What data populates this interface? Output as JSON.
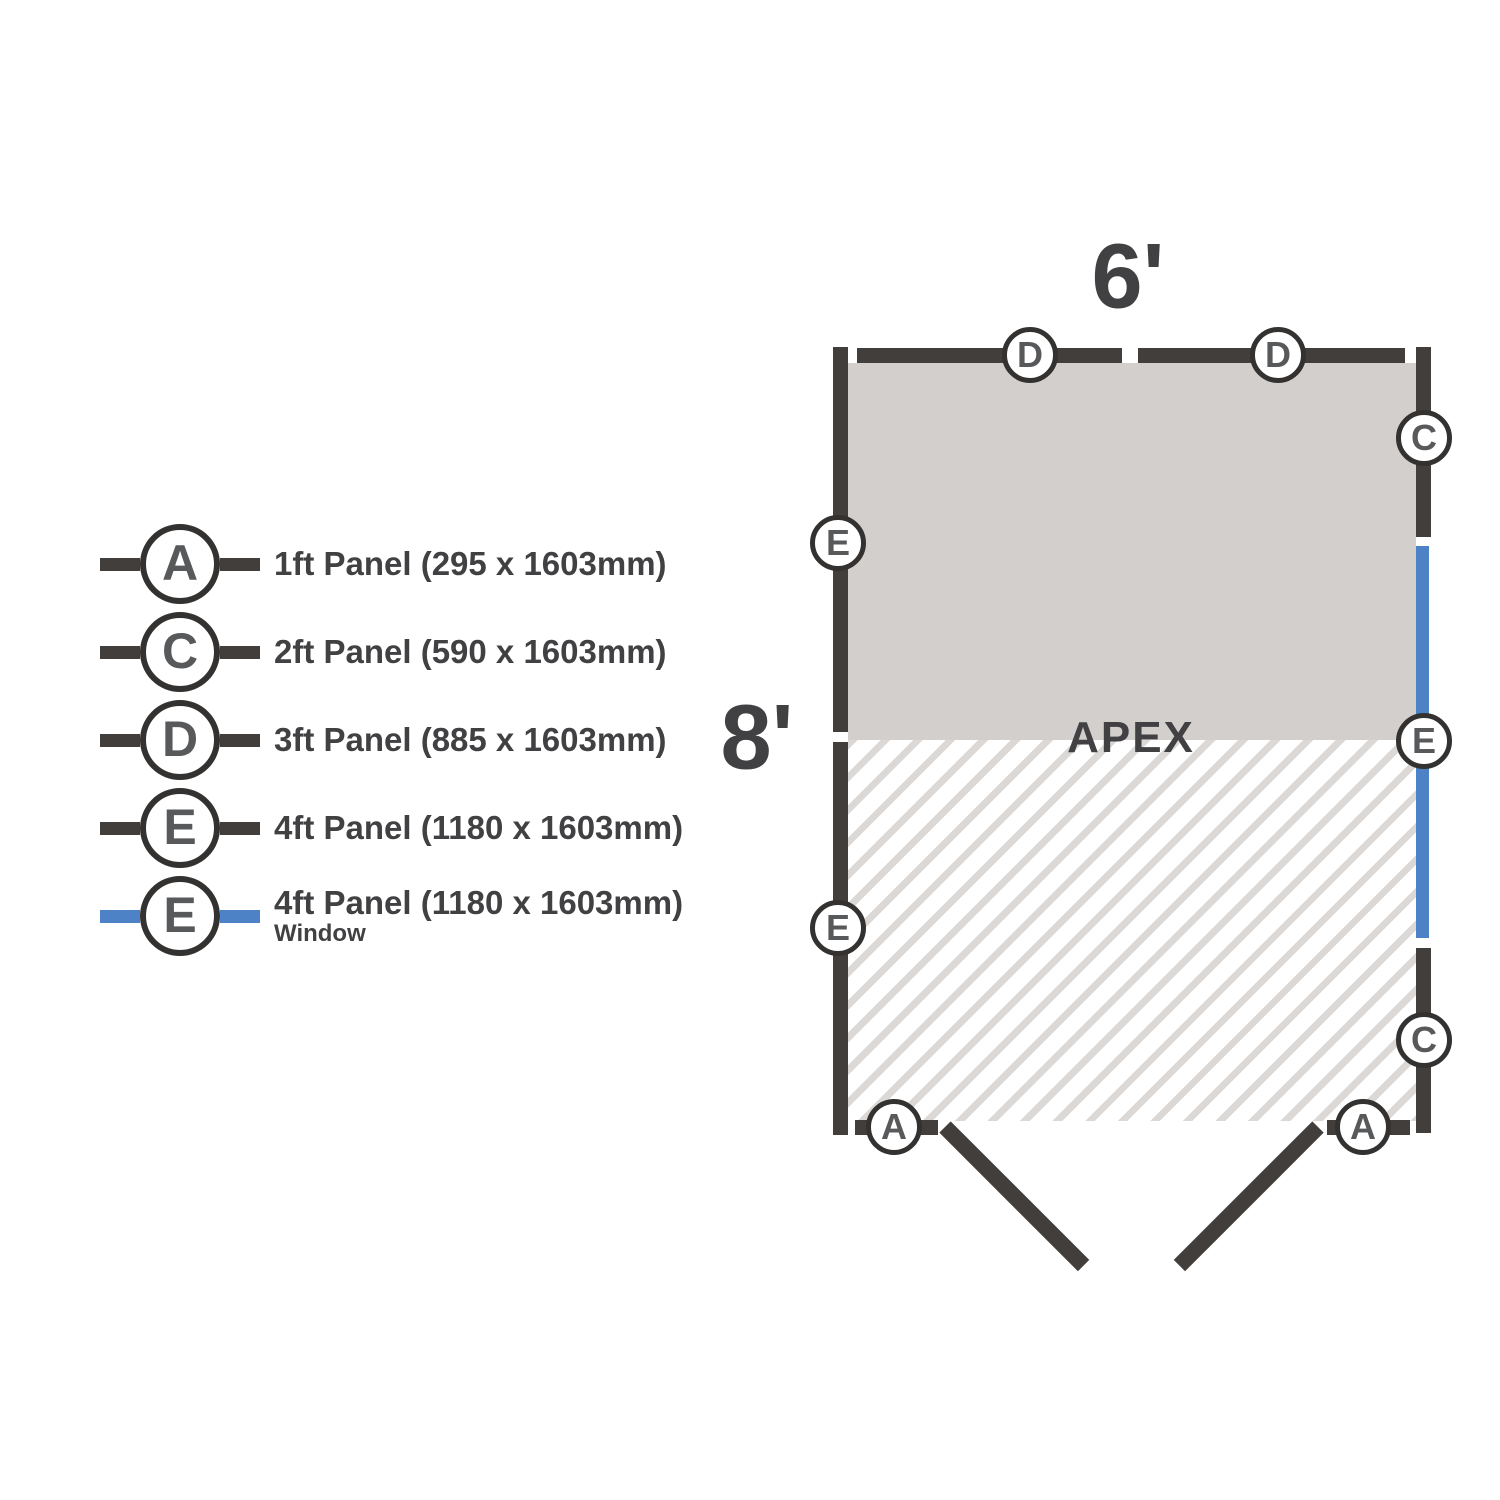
{
  "colors": {
    "wall_dark": "#423e3b",
    "window_blue": "#4e82c6",
    "letter_grey": "#58595b",
    "text_grey": "#414042",
    "floor_fill": "#d2cfcd",
    "hatch_stripe": "#dbd8d6",
    "background": "#ffffff"
  },
  "legend": {
    "items": [
      {
        "key": "A",
        "label": "1ft Panel (295 x 1603mm)",
        "line": "dark"
      },
      {
        "key": "C",
        "label": "2ft Panel (590 x 1603mm)",
        "line": "dark"
      },
      {
        "key": "D",
        "label": "3ft Panel (885 x 1603mm)",
        "line": "dark"
      },
      {
        "key": "E",
        "label": "4ft Panel (1180 x 1603mm)",
        "line": "dark"
      },
      {
        "key": "E",
        "label": "4ft Panel (1180 x 1603mm)",
        "sublabel": "Window",
        "line": "blue"
      }
    ]
  },
  "plan": {
    "width_label": "6'",
    "depth_label": "8'",
    "apex_label": "APEX",
    "markers": [
      {
        "label": "D",
        "side": "top"
      },
      {
        "label": "D",
        "side": "top"
      },
      {
        "label": "C",
        "side": "right"
      },
      {
        "label": "E",
        "side": "left"
      },
      {
        "label": "E",
        "side": "right-window"
      },
      {
        "label": "E",
        "side": "left"
      },
      {
        "label": "C",
        "side": "right"
      },
      {
        "label": "A",
        "side": "bottom"
      },
      {
        "label": "A",
        "side": "bottom"
      }
    ]
  }
}
